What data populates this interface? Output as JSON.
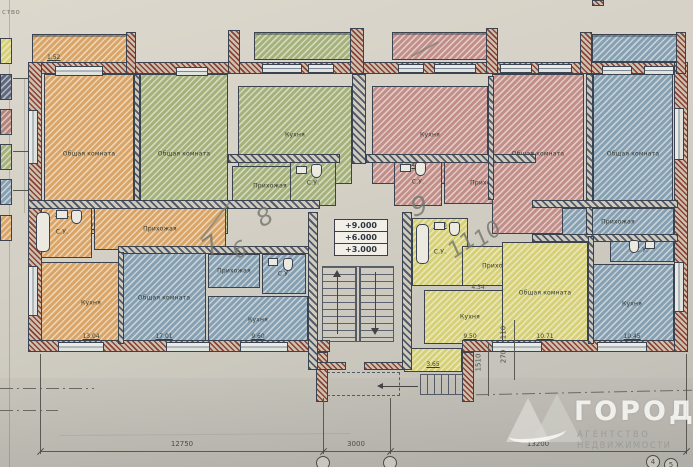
{
  "document": {
    "type_note": "ство"
  },
  "colors": {
    "paper": "#d6d2c7",
    "orange": "#d9a466",
    "green": "#a4b17b",
    "red": "#c28e89",
    "blue": "#859fb3",
    "yellow": "#d6d077",
    "navy_wall": "#515a6e",
    "red_wall": "#8d4136",
    "line": "#3c4350",
    "pencil": "#73766f"
  },
  "legend": [
    {
      "name": "yellow-swatch",
      "color": "#d6d077"
    },
    {
      "name": "navy-swatch",
      "color": "#5d6880"
    },
    {
      "name": "red-brown-swatch",
      "color": "#b4837b"
    },
    {
      "name": "green-swatch",
      "color": "#a4b17b"
    },
    {
      "name": "blue-swatch",
      "color": "#859fb3"
    },
    {
      "name": "orange-swatch",
      "color": "#d9a466"
    }
  ],
  "elevation_marks": [
    "+9.000",
    "+6.000",
    "+3.000"
  ],
  "rooms": [
    {
      "name": "living-room-1",
      "label": "Общая комната",
      "area": "16.71",
      "color": "orange",
      "rect": [
        44,
        74,
        90,
        160
      ]
    },
    {
      "name": "living-room-2",
      "label": "Общая комната",
      "area": "",
      "color": "green",
      "rect": [
        140,
        74,
        88,
        160
      ]
    },
    {
      "name": "kitchen-2",
      "label": "Кухня",
      "area": "7.65",
      "color": "green",
      "rect": [
        238,
        86,
        114,
        98
      ]
    },
    {
      "name": "hall-2",
      "label": "Прихожая",
      "area": "",
      "color": "green",
      "rect": [
        232,
        166,
        76,
        40
      ]
    },
    {
      "name": "wc-2",
      "label": "С.У.",
      "area": "",
      "color": "green",
      "rect": [
        290,
        160,
        46,
        46
      ]
    },
    {
      "name": "kitchen-3",
      "label": "Кухня",
      "area": "10.67",
      "color": "red",
      "rect": [
        372,
        86,
        116,
        98
      ]
    },
    {
      "name": "wc-3",
      "label": "С.У.",
      "area": "4.61",
      "color": "red",
      "rect": [
        394,
        158,
        48,
        48
      ],
      "area_top": true
    },
    {
      "name": "hall-3",
      "label": "Прихожая",
      "area": "",
      "color": "red",
      "rect": [
        444,
        162,
        86,
        42
      ]
    },
    {
      "name": "living-room-3",
      "label": "Общая комната",
      "area": "",
      "color": "red",
      "rect": [
        492,
        74,
        92,
        160
      ]
    },
    {
      "name": "living-room-4",
      "label": "Общая комната",
      "area": "",
      "color": "blue",
      "rect": [
        593,
        74,
        80,
        160
      ]
    },
    {
      "name": "hall-4",
      "label": "Прихожая",
      "area": "",
      "color": "blue",
      "rect": [
        562,
        208,
        112,
        28
      ]
    },
    {
      "name": "wc-4",
      "label": "С.У.",
      "area": "",
      "color": "blue",
      "rect": [
        610,
        238,
        64,
        24
      ]
    },
    {
      "name": "kitchen-4",
      "label": "Кухня",
      "area": "10.45",
      "color": "blue",
      "rect": [
        590,
        264,
        84,
        80
      ]
    },
    {
      "name": "wc-1",
      "label": "С.У.",
      "area": "4.07",
      "color": "orange",
      "rect": [
        32,
        206,
        60,
        52
      ],
      "area_top": true
    },
    {
      "name": "hall-1",
      "label": "Прихожая",
      "area": "",
      "color": "orange",
      "rect": [
        94,
        208,
        132,
        42
      ]
    },
    {
      "name": "kitchen-1",
      "label": "Кухня",
      "area": "13.04",
      "color": "orange",
      "rect": [
        32,
        262,
        118,
        82
      ]
    },
    {
      "name": "living-room-5",
      "label": "Общая комната",
      "area": "17.01",
      "color": "blue",
      "rect": [
        122,
        252,
        84,
        92
      ]
    },
    {
      "name": "hall-5",
      "label": "Прихожая",
      "area": "",
      "color": "blue",
      "rect": [
        208,
        254,
        52,
        34
      ]
    },
    {
      "name": "wc-5",
      "label": "С.У.",
      "area": "",
      "color": "blue",
      "rect": [
        262,
        254,
        44,
        40
      ]
    },
    {
      "name": "kitchen-5",
      "label": "Кухня",
      "area": "9.60",
      "color": "blue",
      "rect": [
        208,
        296,
        100,
        48
      ]
    },
    {
      "name": "wc-6",
      "label": "С.У.",
      "area": "4.20",
      "color": "yellow",
      "rect": [
        412,
        218,
        56,
        68
      ],
      "area_top": true
    },
    {
      "name": "hall-6",
      "label": "Прихожая",
      "area": "",
      "color": "yellow",
      "rect": [
        462,
        246,
        74,
        40
      ]
    },
    {
      "name": "kitchen-6",
      "label": "Кухня",
      "area": "9.50",
      "color": "yellow",
      "rect": [
        424,
        290,
        92,
        54
      ]
    },
    {
      "name": "living-room-6",
      "label": "Общая комната",
      "area": "10.71",
      "color": "yellow",
      "rect": [
        502,
        242,
        86,
        102
      ]
    },
    {
      "name": "entry-vestibule",
      "label": "",
      "area": "3.65",
      "color": "yellow",
      "rect": [
        404,
        348,
        58,
        24
      ]
    }
  ],
  "balconies": [
    {
      "name": "balcony-1",
      "color": "orange",
      "rect": [
        32,
        34,
        96,
        30
      ],
      "dim": "1.52"
    },
    {
      "name": "balcony-2",
      "color": "green",
      "rect": [
        254,
        32,
        98,
        28
      ],
      "dim": ""
    },
    {
      "name": "balcony-3",
      "color": "red",
      "rect": [
        392,
        32,
        98,
        28
      ],
      "dim": ""
    },
    {
      "name": "balcony-4",
      "color": "blue",
      "rect": [
        592,
        34,
        86,
        28
      ],
      "dim": ""
    }
  ],
  "dimensions": {
    "bottom": [
      {
        "text": "12750",
        "x": 182,
        "y": 440
      },
      {
        "text": "3000",
        "x": 356,
        "y": 440
      },
      {
        "text": "13200",
        "x": 538,
        "y": 440
      }
    ],
    "vertical": [
      {
        "text": "1510",
        "x": 479,
        "y": 358
      },
      {
        "text": "270",
        "x": 504,
        "y": 352
      },
      {
        "text": "110",
        "x": 504,
        "y": 328
      }
    ],
    "extra": [
      {
        "text": "4.34",
        "x": 478,
        "y": 284
      }
    ]
  },
  "axis_bubbles": [
    {
      "label": "",
      "x": 316,
      "y": 456
    },
    {
      "label": "",
      "x": 383,
      "y": 456
    },
    {
      "label": "4",
      "x": 646,
      "y": 455
    },
    {
      "label": "5",
      "x": 664,
      "y": 458
    }
  ],
  "handwritten": [
    {
      "text": "7",
      "x": 203,
      "y": 231,
      "size": 25,
      "rot": -35
    },
    {
      "text": "6",
      "x": 233,
      "y": 238,
      "size": 22,
      "rot": -25
    },
    {
      "text": "8",
      "x": 257,
      "y": 203,
      "size": 24,
      "rot": -30
    },
    {
      "text": "9",
      "x": 411,
      "y": 192,
      "size": 26,
      "rot": -15
    },
    {
      "text": "11",
      "x": 448,
      "y": 233,
      "size": 22,
      "rot": -35
    },
    {
      "text": "10",
      "x": 474,
      "y": 222,
      "size": 22,
      "rot": -35
    }
  ],
  "watermark": {
    "title": "ГОРОД",
    "subtitle1": "АГЕНТСТВО",
    "subtitle2": "НЕДВИЖИМОСТИ"
  },
  "layout": {
    "walls_ext": [
      [
        28,
        62,
        660,
        12
      ],
      [
        28,
        62,
        14,
        290
      ],
      [
        28,
        340,
        302,
        12
      ],
      [
        462,
        340,
        226,
        12
      ],
      [
        674,
        62,
        14,
        290
      ],
      [
        126,
        32,
        10,
        42
      ],
      [
        228,
        30,
        12,
        44
      ],
      [
        350,
        28,
        14,
        46
      ],
      [
        486,
        28,
        12,
        46
      ],
      [
        580,
        32,
        12,
        42
      ],
      [
        676,
        32,
        10,
        42
      ],
      [
        316,
        352,
        12,
        50
      ],
      [
        462,
        352,
        12,
        50
      ],
      [
        308,
        362,
        38,
        8
      ],
      [
        364,
        362,
        48,
        8
      ],
      [
        592,
        0,
        12,
        6
      ]
    ],
    "walls_int": [
      [
        134,
        74,
        6,
        130
      ],
      [
        352,
        74,
        14,
        90
      ],
      [
        586,
        74,
        7,
        162
      ],
      [
        28,
        200,
        292,
        9
      ],
      [
        228,
        154,
        112,
        9
      ],
      [
        366,
        154,
        170,
        9
      ],
      [
        532,
        200,
        146,
        8
      ],
      [
        532,
        234,
        146,
        8
      ],
      [
        118,
        246,
        196,
        8
      ],
      [
        118,
        252,
        6,
        92
      ],
      [
        308,
        212,
        10,
        158
      ],
      [
        402,
        212,
        10,
        158
      ],
      [
        588,
        236,
        6,
        108
      ],
      [
        488,
        76,
        6,
        124
      ]
    ],
    "windows": [
      [
        55,
        66,
        48,
        10
      ],
      [
        176,
        67,
        32,
        9
      ],
      [
        262,
        64,
        40,
        9
      ],
      [
        308,
        64,
        26,
        9
      ],
      [
        398,
        64,
        26,
        9
      ],
      [
        434,
        64,
        42,
        9
      ],
      [
        500,
        64,
        32,
        9
      ],
      [
        538,
        64,
        34,
        9
      ],
      [
        602,
        66,
        30,
        9
      ],
      [
        644,
        66,
        30,
        9
      ],
      [
        58,
        342,
        46,
        10
      ],
      [
        166,
        342,
        44,
        10
      ],
      [
        240,
        342,
        48,
        10
      ],
      [
        492,
        342,
        50,
        10
      ],
      [
        597,
        342,
        50,
        10
      ],
      [
        28,
        110,
        10,
        54
      ],
      [
        28,
        266,
        10,
        50
      ],
      [
        674,
        108,
        10,
        52
      ],
      [
        674,
        262,
        10,
        50
      ]
    ],
    "fixtures": [
      [
        "tub",
        [
          36,
          212,
          14,
          40
        ]
      ],
      [
        "sink",
        [
          56,
          210,
          12,
          9
        ]
      ],
      [
        "wc",
        [
          71,
          210,
          11,
          14
        ]
      ],
      [
        "sink",
        [
          296,
          166,
          11,
          8
        ]
      ],
      [
        "wc",
        [
          311,
          164,
          11,
          14
        ]
      ],
      [
        "sink",
        [
          400,
          164,
          11,
          8
        ]
      ],
      [
        "wc",
        [
          415,
          162,
          11,
          14
        ]
      ],
      [
        "sink",
        [
          268,
          258,
          10,
          8
        ]
      ],
      [
        "wc",
        [
          283,
          258,
          10,
          13
        ]
      ],
      [
        "tub",
        [
          416,
          224,
          13,
          40
        ]
      ],
      [
        "sink",
        [
          434,
          222,
          11,
          8
        ]
      ],
      [
        "wc",
        [
          449,
          222,
          11,
          14
        ]
      ],
      [
        "sink",
        [
          645,
          241,
          10,
          8
        ]
      ],
      [
        "wc",
        [
          629,
          240,
          10,
          13
        ]
      ]
    ],
    "stairs": {
      "box": [
        318,
        258,
        84,
        104
      ],
      "flights": [
        [
          322,
          266,
          34,
          76
        ],
        [
          360,
          266,
          34,
          76
        ]
      ],
      "divider": [
        356,
        266,
        4,
        76
      ]
    },
    "porch": {
      "dash": [
        322,
        372,
        78,
        24
      ],
      "steps": [
        420,
        374,
        50,
        21
      ],
      "arrow": [
        382,
        386,
        36
      ]
    },
    "dim_lines": {
      "h": [
        [
          40,
          451,
          646
        ]
      ],
      "v": [
        [
          40,
          354,
          100
        ],
        [
          323,
          398,
          56
        ],
        [
          390,
          398,
          56
        ],
        [
          686,
          354,
          100
        ],
        [
          514,
          320,
          60
        ],
        [
          488,
          344,
          52
        ]
      ],
      "ticks": [
        [
          40,
          451
        ],
        [
          323,
          451
        ],
        [
          390,
          451
        ],
        [
          686,
          451
        ]
      ],
      "dashdot": [
        [
          0,
          388,
          94
        ],
        [
          0,
          410,
          58
        ],
        [
          476,
          392,
          216
        ]
      ]
    },
    "pencil_strokes": [
      [
        214,
        198,
        46,
        38
      ],
      [
        424,
        34,
        30,
        62
      ]
    ],
    "legend_pos": {
      "x": 0,
      "w": 12,
      "h": 26,
      "ys": [
        38,
        74,
        109,
        144,
        179,
        215
      ],
      "leaders": [
        [
          13,
          78,
          16
        ],
        [
          13,
          151,
          16
        ],
        [
          13,
          190,
          16
        ]
      ],
      "spine": [
        24,
        78,
        135
      ]
    },
    "photo_lines": {
      "left_edge": [
        9,
        0,
        467
      ],
      "crease": [
        60,
        434,
        290
      ]
    }
  }
}
